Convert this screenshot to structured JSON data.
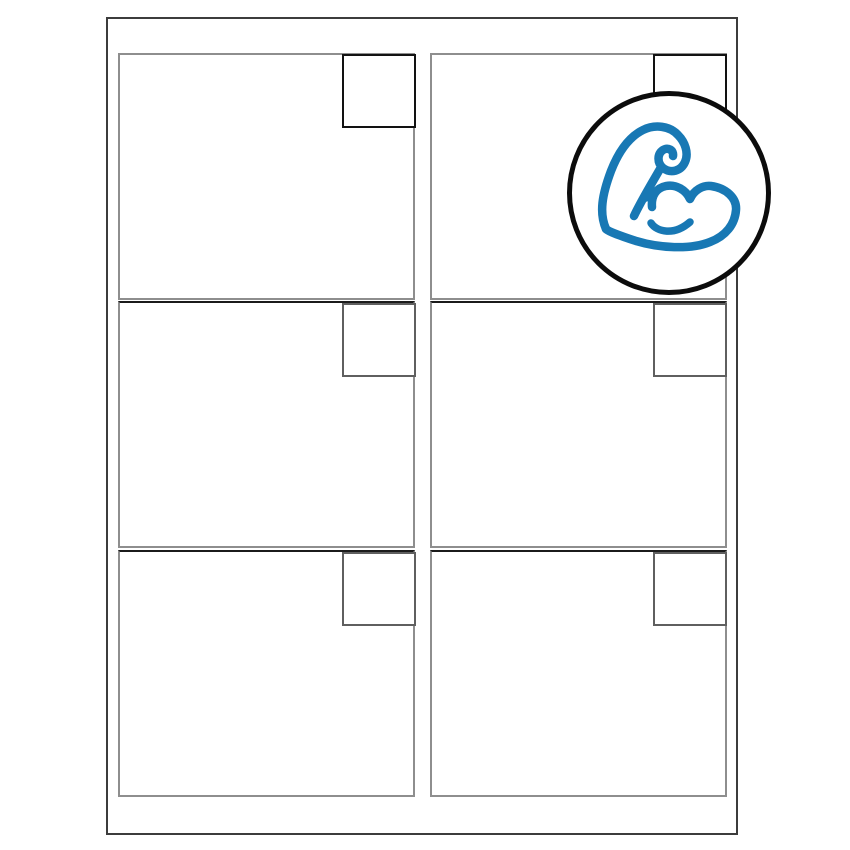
{
  "colors": {
    "background": "#ffffff",
    "accent": "#1878b4",
    "ring": "#0c0c0c",
    "sheet_border": "#3c3c3c",
    "label_border": "#8e8e8e",
    "row_divider": "#1b1b1b",
    "tab_dark": "#121212",
    "tab_light": "#5f5f5f"
  },
  "sheet": {
    "grid": {
      "rows": 3,
      "columns": 2
    },
    "label_count": 6,
    "labels_blank": true,
    "corner_tab_per_label": true
  },
  "badge": {
    "shape": "circle",
    "icon": "flexed-bicep-icon",
    "fill": "#ffffff",
    "position": "top-right-over-sheet"
  }
}
